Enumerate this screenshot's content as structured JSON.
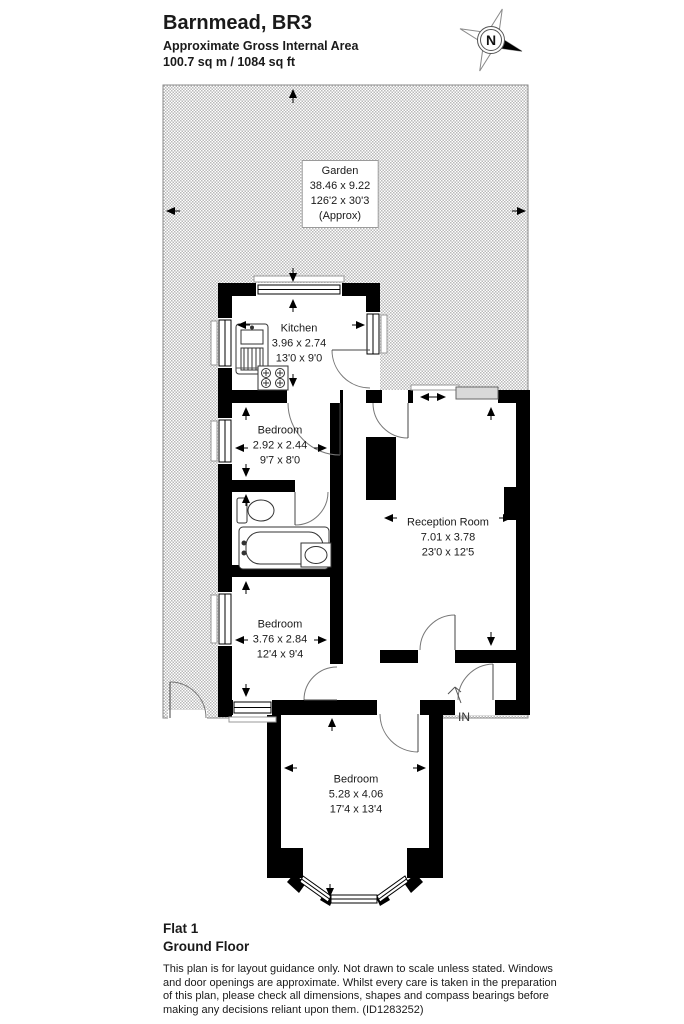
{
  "header": {
    "title": "Barnmead, BR3",
    "subtitle": "Approximate Gross Internal Area",
    "area": "100.7 sq m / 1084 sq ft"
  },
  "compass": {
    "label": "N"
  },
  "garden": {
    "name": "Garden",
    "metric": "38.46 x 9.22",
    "imperial": "126'2 x 30'3",
    "approx": "(Approx)"
  },
  "rooms": [
    {
      "name": "Kitchen",
      "metric": "3.96 x 2.74",
      "imperial": "13'0 x 9'0"
    },
    {
      "name": "Bedroom",
      "metric": "2.92 x 2.44",
      "imperial": "9'7 x 8'0"
    },
    {
      "name": "Reception Room",
      "metric": "7.01 x 3.78",
      "imperial": "23'0 x 12'5"
    },
    {
      "name": "Bedroom",
      "metric": "3.76 x 2.84",
      "imperial": "12'4 x 9'4"
    },
    {
      "name": "Bedroom",
      "metric": "5.28 x 4.06",
      "imperial": "17'4 x 13'4"
    }
  ],
  "entrance": {
    "label": "IN"
  },
  "footer": {
    "flat": "Flat 1",
    "floor": "Ground Floor",
    "disclaimer": "This plan is for layout guidance only. Not drawn to scale unless stated. Windows and door openings are approximate. Whilst every care is taken in the preparation of this plan, please check all dimensions, shapes and compass bearings before making any decisions reliant upon them. (ID1283252)"
  },
  "fixtures": [
    "kitchen-sink",
    "hob",
    "toilet",
    "bath",
    "basin"
  ],
  "colors": {
    "wall": "#000000",
    "garden_dot": "#b9b9b9",
    "window_gray": "#d9d9d9"
  }
}
